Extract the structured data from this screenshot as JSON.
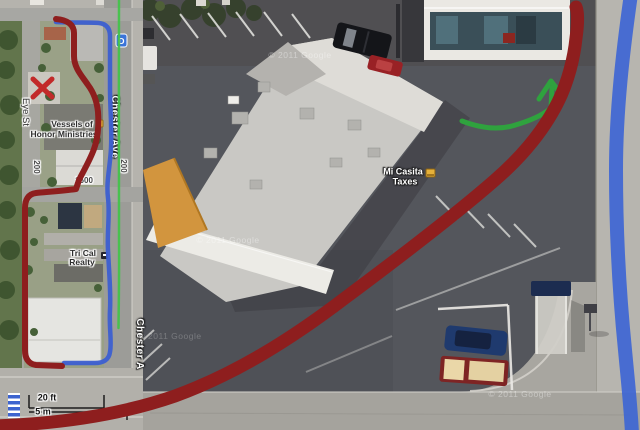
{
  "inset_map": {
    "streets": {
      "eye_st": "Eye St",
      "chester_ave": "Chester Ave",
      "chester_ave_lower": "Chester A",
      "block_left": "200",
      "block_right": "200",
      "block_1500": "1500"
    },
    "pois": {
      "vessels": {
        "line1": "Vessels of",
        "line2": "Honor Ministries"
      },
      "tricail": {
        "line1": "Tri Cal",
        "line2": "Realty"
      }
    },
    "transit_marker_label": "D",
    "scale_bar": {
      "feet": "20 ft",
      "meters": "5 m"
    }
  },
  "aerial_view": {
    "poi_mi_casita": {
      "line1": "Mi Casita",
      "line2": "Taxes"
    },
    "watermark": "© 2011 Google"
  },
  "annotations": {
    "colors": {
      "route_red": "#8e1e1e",
      "route_blue": "#3c5fd1",
      "edge_blue": "#3e66d4",
      "arrow_green": "#2fa23e",
      "transit_green": "#43c34b",
      "x_red": "#c22a2a"
    }
  }
}
